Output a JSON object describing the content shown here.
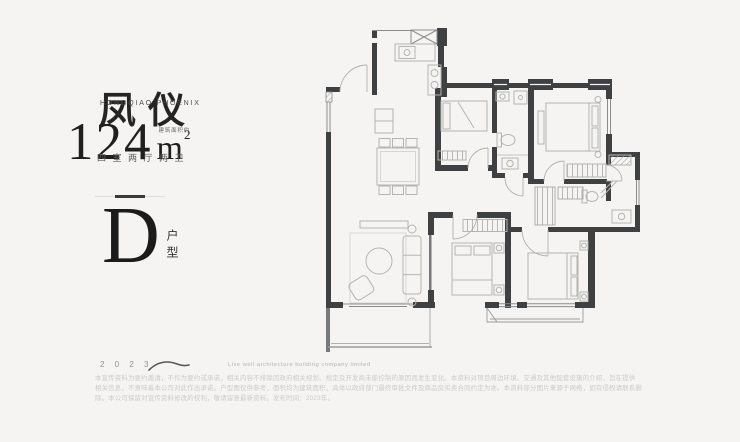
{
  "brand": {
    "title": "凤仪",
    "subtitle": "HONGQIAO PHOENIX"
  },
  "area": {
    "note": "建筑面积约",
    "value": "124",
    "unit": "m",
    "sup": "2",
    "layout": "四室两厅两卫"
  },
  "unit_type": {
    "letter": "D",
    "label": "户型"
  },
  "footer": {
    "year": "2 0 2 3",
    "tagline": "Live well architecture building company limited",
    "disclaimer": [
      "本宣传资料为要约邀请，不作为要约或承诺，相关内容不排除因政府相关规划、规定及开发商未能控制的原因而发生变化。本资料对项目周边环境、交通及其他配套设施的介绍，旨在提供",
      "相关信息，不意味着本公司对此作出承诺。户型图仅供参考，面积均为建筑面积，具体以政府部门最终审批文件及商品房买卖合同约定为准。本资料部分图片来源于网络，如有侵权请联系删",
      "除。本公司保留对宣传资料修改的权利，敬请留意最新资料。发布时间：2023年。"
    ]
  },
  "floorplan_icons": {
    "walls": "wall-segments",
    "windows": "window-glazing",
    "doors": "door-swing-arcs",
    "furniture": "beds-sofa-dining-kitchen-bath-fixtures"
  },
  "colors": {
    "background": "#f5f4f2",
    "wall": "#3f4042",
    "wall_medium": "#77787a",
    "furniture_line": "#b4b5b3",
    "text_dark": "#232323",
    "text_muted": "#8f8f8d",
    "disclaimer": "#cbcbc9"
  }
}
